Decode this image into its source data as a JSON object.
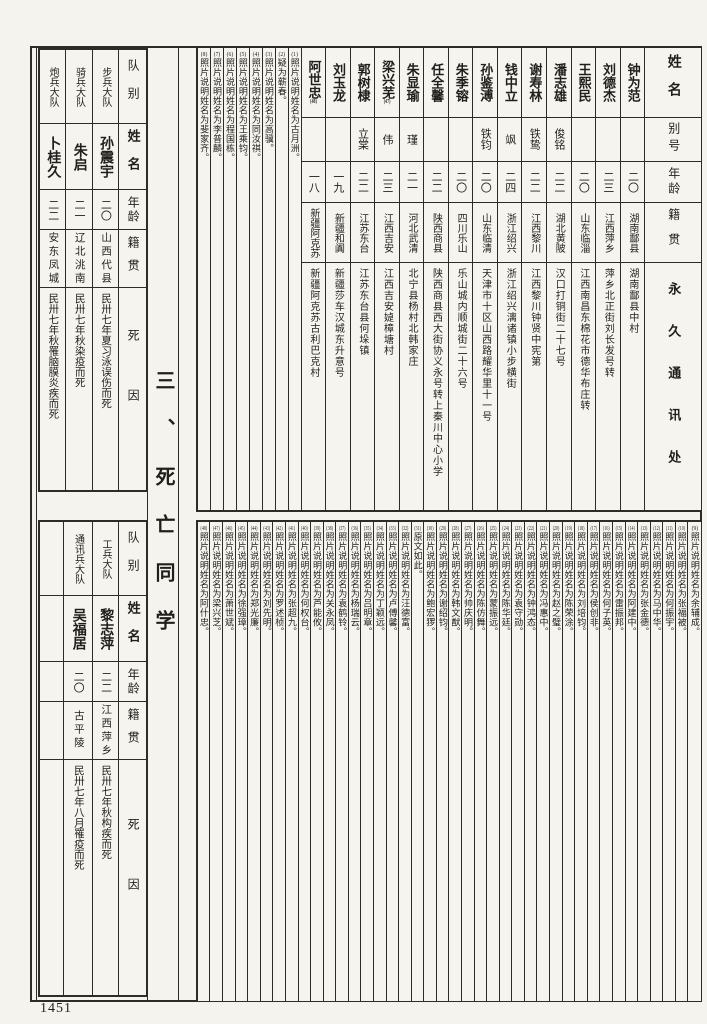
{
  "page": {
    "number": "1451",
    "section_title": "三、死亡同学"
  },
  "roster": {
    "headers": [
      "姓名",
      "别号",
      "年龄",
      "籍贯",
      "永久通讯处"
    ],
    "people": [
      {
        "name": "钟为范",
        "mark": "",
        "alias": "",
        "age": "二〇",
        "origin": "湖南酃县",
        "address": "湖南酃县中村"
      },
      {
        "name": "刘德杰",
        "mark": "",
        "alias": "",
        "age": "二三",
        "origin": "江西萍乡",
        "address": "萍乡北正街刘长发号转"
      },
      {
        "name": "王熙民",
        "mark": "",
        "alias": "",
        "age": "二〇",
        "origin": "山东临淄",
        "address": "江西南昌东棉花市德华布庄转"
      },
      {
        "name": "潘志雄",
        "mark": "",
        "alias": "俊铭",
        "age": "二二",
        "origin": "湖北黄陂",
        "address": "汉口打铜街二十七号"
      },
      {
        "name": "谢寿林",
        "mark": "",
        "alias": "铁鸷",
        "age": "二二",
        "origin": "江西黎川",
        "address": "江西黎川钟贤中宪第"
      },
      {
        "name": "钱中立",
        "mark": "",
        "alias": "飒",
        "age": "二四",
        "origin": "浙江绍兴",
        "address": "浙江绍兴漓诸镇小步横街"
      },
      {
        "name": "孙鉴溥",
        "mark": "",
        "alias": "铁钧",
        "age": "二〇",
        "origin": "山东临清",
        "address": "天津市十区山西路耀华里十一号"
      },
      {
        "name": "朱季镕",
        "mark": "",
        "alias": "",
        "age": "二〇",
        "origin": "四川乐山",
        "address": "乐山城内顺城街二十六号"
      },
      {
        "name": "任全馨",
        "mark": "",
        "alias": "",
        "age": "二二",
        "origin": "陕西商县",
        "address": "陕西商县西大街协义永号转上秦川中心小学"
      },
      {
        "name": "朱显瑜",
        "mark": "",
        "alias": "瑾",
        "age": "二一",
        "origin": "河北武清",
        "address": "北宁县杨村北韩家庄"
      },
      {
        "name": "梁兴芜",
        "mark": "(47)",
        "alias": "伟",
        "age": "二三",
        "origin": "江西吉安",
        "address": "江西吉安媫樟塘村"
      },
      {
        "name": "郭树棣",
        "mark": "",
        "alias": "立棠",
        "age": "二二",
        "origin": "江苏东台",
        "address": "江苏东台县何垛镇"
      },
      {
        "name": "刘玉龙",
        "mark": "",
        "alias": "",
        "age": "一九",
        "origin": "新疆和阗",
        "address": "新疆莎车汉城东升意号"
      },
      {
        "name": "阿世忠",
        "mark": "(48)",
        "alias": "",
        "age": "一八",
        "origin": "新疆阿克苏",
        "address": "新疆阿克苏古利巴克村"
      }
    ],
    "notes": [
      {
        "num": "(1)",
        "text": "照片说明姓名为古月洲。"
      },
      {
        "num": "(2)",
        "text": "疑为蕲春。"
      },
      {
        "num": "(3)",
        "text": "照片说明姓名为高骥。"
      },
      {
        "num": "(4)",
        "text": "照片说明姓名为同汝祺。"
      },
      {
        "num": "(5)",
        "text": "照片说明姓名为王乘钧。"
      },
      {
        "num": "(6)",
        "text": "照片说明姓名为程国栋。"
      },
      {
        "num": "(7)",
        "text": "照片说明姓名为李普麟。"
      },
      {
        "num": "(8)",
        "text": "照片说明姓名为斐家齐。"
      }
    ]
  },
  "death": {
    "headers": [
      "队别",
      "姓名",
      "年龄",
      "籍贯",
      "死因"
    ],
    "top_rows": [
      {
        "unit": "步兵大队",
        "name": "孙震宇",
        "age": "二〇",
        "origin": "山西代县",
        "cause": "民卅七年夏习泳误伤而死"
      },
      {
        "unit": "骑兵大队",
        "name": "朱启",
        "age": "二一",
        "origin": "辽北洮南",
        "cause": "民卅七年秋染疫而死"
      },
      {
        "unit": "炮兵大队",
        "name": "卜桂久",
        "age": "二二",
        "origin": "安东凤城",
        "cause": "民卅七年秋罹脑膜炎疾而死"
      }
    ],
    "bottom_rows": [
      {
        "unit": "工兵大队",
        "name": "黎志萍",
        "age": "二二",
        "origin": "江西萍乡",
        "cause": "民卅七年秋构疾而死"
      },
      {
        "unit": "通讯兵大队",
        "name": "吴福居",
        "age": "二〇",
        "origin": "古平陵",
        "cause": "民卅七年八月罹疫而死"
      },
      {
        "unit": "",
        "name": "",
        "age": "",
        "origin": "",
        "cause": ""
      }
    ]
  },
  "bottom_notes": [
    {
      "num": "(9)",
      "text": "照片说明姓名为余辅成。"
    },
    {
      "num": "(10)",
      "text": "照片说明姓名为张福被。"
    },
    {
      "num": "(11)",
      "text": "照片说明姓名为何振宇。"
    },
    {
      "num": "(12)",
      "text": "照片说明姓名为马中华。"
    },
    {
      "num": "(13)",
      "text": "照片说明姓名为张金德。"
    },
    {
      "num": "(14)",
      "text": "照片说明姓名为阿建中。"
    },
    {
      "num": "(15)",
      "text": "照片说明姓名为雷振邦。"
    },
    {
      "num": "(16)",
      "text": "照片说明姓名为何子英。"
    },
    {
      "num": "(17)",
      "text": "照片说明姓名为侯创非。"
    },
    {
      "num": "(18)",
      "text": "照片说明姓名为刘培钧。"
    },
    {
      "num": "(19)",
      "text": "照片说明姓名为陈荣涂。"
    },
    {
      "num": "(20)",
      "text": "照片说明姓名为赵之璧。"
    },
    {
      "num": "(21)",
      "text": "照片说明姓名为冯惠中。"
    },
    {
      "num": "(22)",
      "text": "照片说明姓名为钟鸿态。"
    },
    {
      "num": "(23)",
      "text": "照片说明姓名为袁守勋。"
    },
    {
      "num": "(24)",
      "text": "照片说明姓名为陈华廷。"
    },
    {
      "num": "(25)",
      "text": "照片说明姓名为蒙振远。"
    },
    {
      "num": "(26)",
      "text": "照片说明姓名为陈仿舞。"
    },
    {
      "num": "(27)",
      "text": "照片说明姓名为帅庆明。"
    },
    {
      "num": "(28)",
      "text": "照片说明姓名为韩文猷。"
    },
    {
      "num": "(29)",
      "text": "照片说明姓名为谢绍钧。"
    },
    {
      "num": "(30)",
      "text": "照片说明姓名为鲍宏猡。"
    },
    {
      "num": "(31)",
      "text": "原文如此。"
    },
    {
      "num": "(32)",
      "text": "照片说明姓名为汪德富。"
    },
    {
      "num": "(33)",
      "text": "照片说明姓名为卢傅馨。"
    },
    {
      "num": "(34)",
      "text": "照片说明姓名为丁颖远。"
    },
    {
      "num": "(35)",
      "text": "照片说明姓名为吕明章。"
    },
    {
      "num": "(36)",
      "text": "照片说明姓名为杨瑞云。"
    },
    {
      "num": "(37)",
      "text": "照片说明姓名为袁鹤铃。"
    },
    {
      "num": "(38)",
      "text": "照片说明姓名为关永凤。"
    },
    {
      "num": "(39)",
      "text": "照片说明姓名为芦能攸。"
    },
    {
      "num": "(40)",
      "text": "照片说明姓名为何权台。"
    },
    {
      "num": "(41)",
      "text": "照片说明姓名为张超九。"
    },
    {
      "num": "(42)",
      "text": "照片说明姓名为罗述桢。"
    },
    {
      "num": "(43)",
      "text": "照片说明姓名为刘先明。"
    },
    {
      "num": "(44)",
      "text": "照片说明姓名为郑光廉。"
    },
    {
      "num": "(45)",
      "text": "照片说明姓名为徐强璋。"
    },
    {
      "num": "(46)",
      "text": "照片说明姓名为萧世斌。"
    },
    {
      "num": "(47)",
      "text": "照片说明姓名为梁兴芝。"
    },
    {
      "num": "(48)",
      "text": "照片说明姓名为阿什忠。"
    }
  ]
}
